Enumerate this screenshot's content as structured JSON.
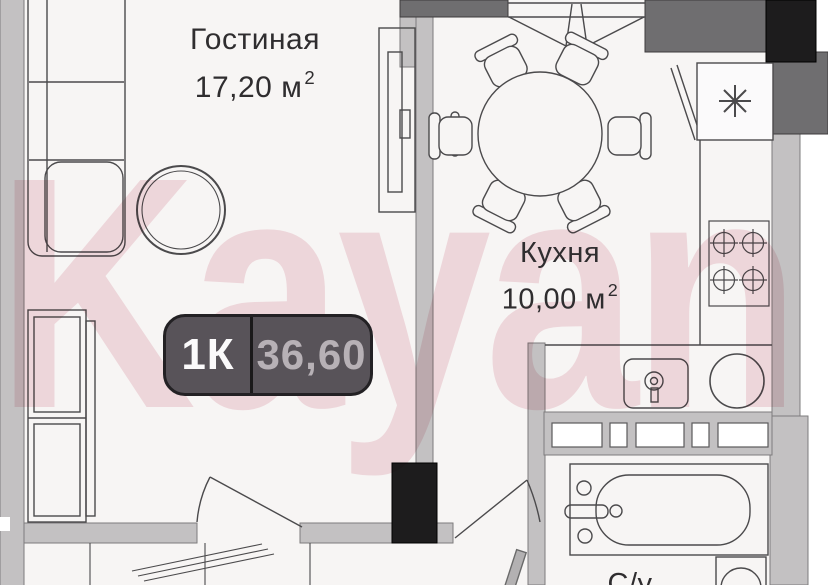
{
  "watermark": {
    "text": "Kayan",
    "color": "#d06080"
  },
  "rooms": {
    "living": {
      "name": "Гостиная",
      "area": "17,20 м",
      "area_sup": "2"
    },
    "kitchen": {
      "name": "Кухня",
      "area": "10,00 м",
      "area_sup": "2"
    },
    "bathroom": {
      "name": "С/у"
    }
  },
  "badge": {
    "rooms": "1К",
    "total_area": "36,60"
  },
  "palette": {
    "floor": "#f7f5f4",
    "wall_light": "#c3c1c2",
    "wall_dark": "#6f6e70",
    "wall_black": "#1d1c1d",
    "line": "#4b4a4c",
    "badge_bg": "#585359",
    "badge_text": "#fbfafb",
    "badge_secondary": "#b7b1b6",
    "watermark_pink": "rgba(205,95,120,0.20)"
  }
}
